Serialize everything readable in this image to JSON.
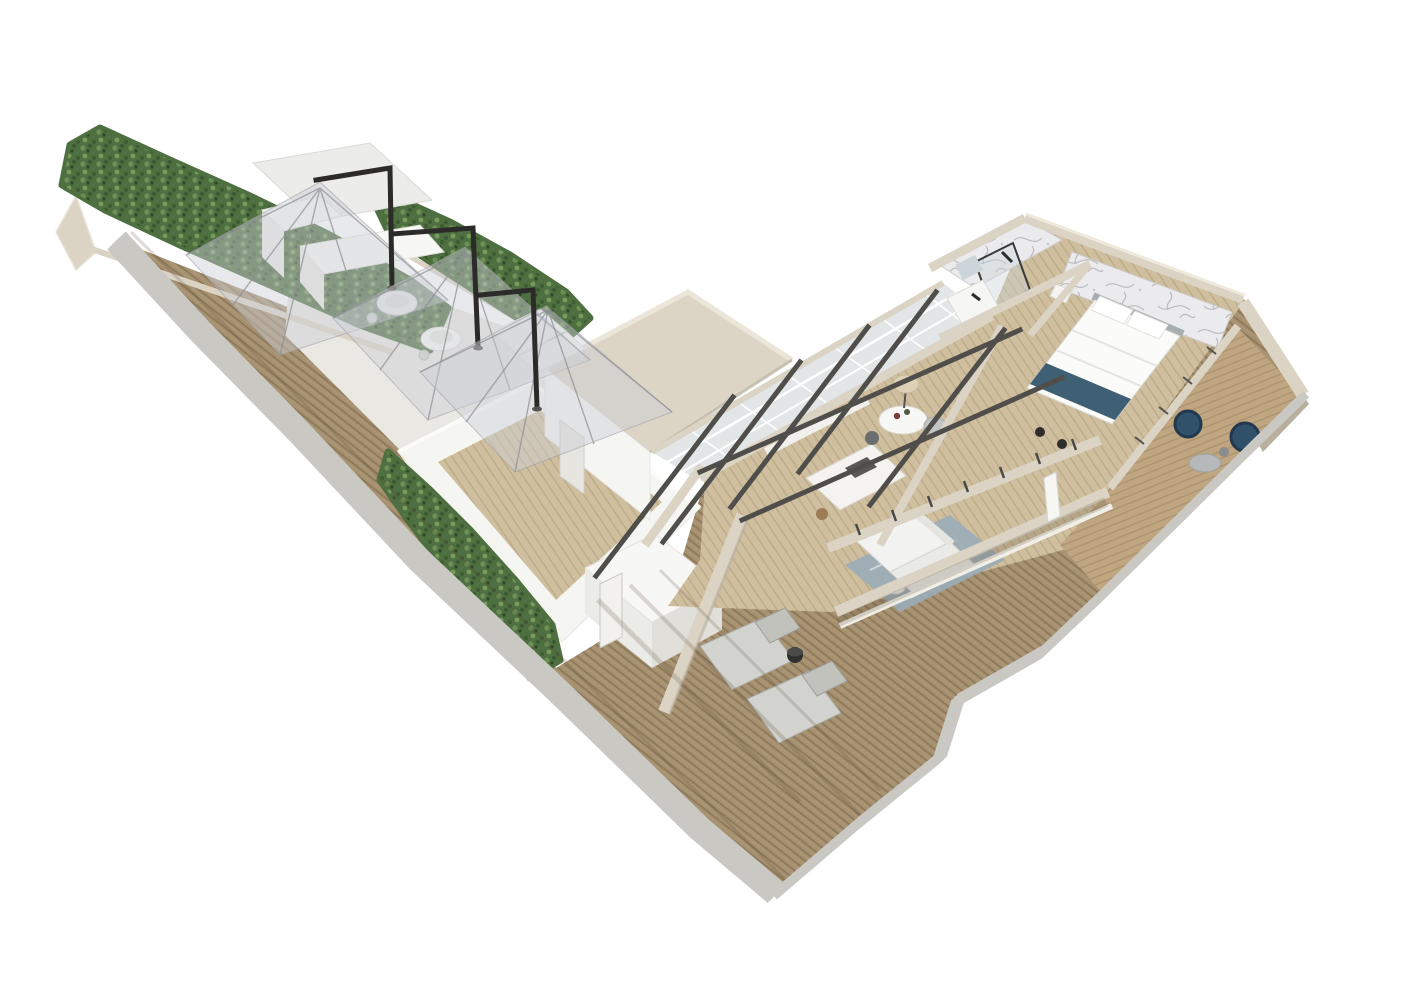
{
  "meta": {
    "description": "Aerial 3D cutaway rendering of a penthouse floor plan with a long rooftop terrace, hedges, cantilever umbrellas, open-plan interior and wrap-around wooden deck",
    "view": "elevated isometric / bird's eye",
    "background": "plain white studio backdrop"
  },
  "palette": {
    "bg": "#ffffff",
    "deck_wood": "#a5906f",
    "deck_stripe": "#8c7759",
    "deck_light": "#b49d7d",
    "interior_wood": "#cfbf9e",
    "interior_stripe": "#bcab89",
    "balcony_wood": "#bfa681",
    "balcony_stripe": "#ab9270",
    "pale_stone": "#e9e8e3",
    "wall_white": "#f5f5f2",
    "wall_white_shade": "#e7e6e1",
    "wall_beige": "#dbd4c5",
    "wall_beige_dark": "#b8b09f",
    "roof_beige": "#dcd5c6",
    "hedge_dark": "#3c5a31",
    "hedge_mid": "#4e7040",
    "hedge_light": "#6f9357",
    "railing_white": "#ffffff",
    "railing_base": "#c9c8c3",
    "beam_dark": "#504e4a",
    "umbrella_frame": "#2c2b29",
    "canopy": "#cdced4",
    "marble_base": "#ebebed",
    "marble_vein": "#a9a9b2",
    "bed_white": "#fbfbfa",
    "bed_teal": "#3f5f74",
    "headboard_grey": "#a8adb2",
    "sofa_white": "#f2f2f0",
    "rug_blue": "#9aacb8",
    "chair_teal": "#31506a",
    "lamp_shade": "#ddd0b6",
    "lounger_grey": "#d2d2ce",
    "table_white": "#f7f7f5",
    "stool_wood": "#9c7b57",
    "shadow": "#5a4a38"
  },
  "scene": {
    "areas": [
      {
        "id": "rooftop-terrace",
        "label": "Rooftop terrace with wooden decking"
      },
      {
        "id": "umbrella-lounge",
        "label": "Paved lounge zone under three cantilever umbrellas"
      },
      {
        "id": "bar-kiosk",
        "label": "White outdoor bar kiosk"
      },
      {
        "id": "courtyard",
        "label": "White walled courtyard with timber floor"
      },
      {
        "id": "service-roof",
        "label": "Flat beige roof volume"
      },
      {
        "id": "skylight",
        "label": "Glazed skylight strip with rafters"
      },
      {
        "id": "kitchen",
        "label": "Kitchen with island"
      },
      {
        "id": "dining",
        "label": "Dining corner with round table and floor lamp"
      },
      {
        "id": "living",
        "label": "Living room with sofa and blue rug"
      },
      {
        "id": "bathroom",
        "label": "Bathroom with marble walls and shower"
      },
      {
        "id": "bedroom",
        "label": "Bedroom with double bed and marble feature wall"
      },
      {
        "id": "balcony",
        "label": "Corner balcony with rattan chairs"
      },
      {
        "id": "sun-deck",
        "label": "Lower sun deck with loungers and railings"
      }
    ],
    "furniture_counts": {
      "cantilever_umbrellas": 3,
      "bistro_tables": 2,
      "sun_loungers": 2,
      "balcony_chairs": 2,
      "dining_tables": 1,
      "beds": 1,
      "sofas": 2
    }
  }
}
